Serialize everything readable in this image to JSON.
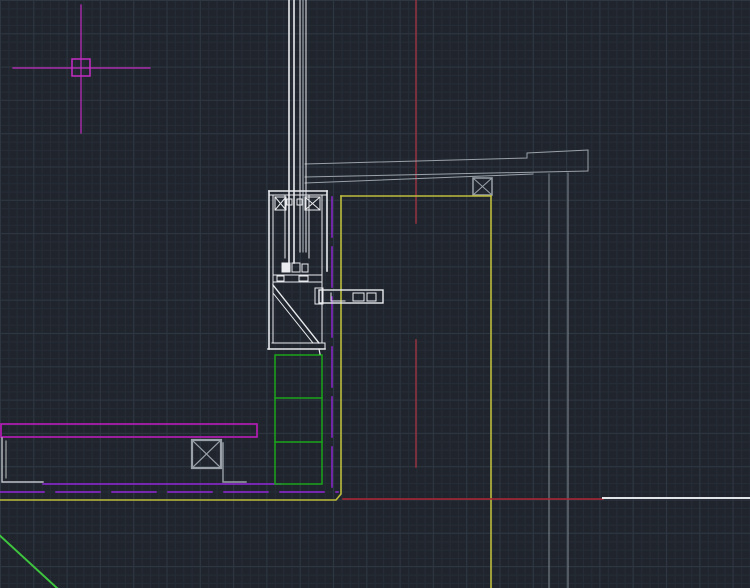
{
  "app": {
    "name": "cad-drawing-viewport",
    "description": "Dark CAD model-space viewport showing a curtain-wall mullion / parapet construction detail section",
    "visible_text": []
  },
  "canvas": {
    "width": 750,
    "height": 588,
    "background": "#20252d",
    "grid": {
      "fine_spacing_px": 8.33,
      "fine_color": "#262c36",
      "major_spacing_px": 33.3,
      "major_color": "#2e3642"
    }
  },
  "palette": {
    "magenta": "#c32cc3",
    "purple": "#9326d9",
    "yellow": "#bdbd3c",
    "green": "#1aa51a",
    "green_bright": "#3fc63f",
    "red_dark": "#963341",
    "red": "#b02533",
    "white": "#e9ebee",
    "light_gray": "#bfc4c9",
    "gray": "#9aa1a8",
    "dim_gray": "#828a92"
  },
  "drawing": {
    "elements": [
      {
        "name": "crosshair-v-line",
        "type": "line",
        "x1": 81,
        "y1": 5,
        "x2": 81,
        "y2": 133,
        "color": "#c32cc3",
        "w": 1.2
      },
      {
        "name": "crosshair-h-line",
        "type": "line",
        "x1": 13,
        "y1": 68,
        "x2": 150,
        "y2": 68,
        "color": "#c32cc3",
        "w": 1.2
      },
      {
        "name": "crosshair-pickbox",
        "type": "rect",
        "x": 72,
        "y": 59,
        "wd": 18,
        "ht": 17,
        "color": "#c32cc3",
        "w": 1.5
      },
      {
        "name": "red-centerline-upper",
        "type": "line",
        "x1": 416,
        "y1": 0,
        "x2": 416,
        "y2": 223,
        "color": "#963341",
        "w": 1.5
      },
      {
        "name": "red-centerline-lower",
        "type": "line",
        "x1": 416,
        "y1": 340,
        "x2": 416,
        "y2": 467,
        "color": "#963341",
        "w": 1.5
      },
      {
        "name": "beam-top-edge",
        "type": "polyline",
        "points": "305,164 527,158 527,153 588,150",
        "color": "#9aa1a8",
        "w": 1
      },
      {
        "name": "beam-bottom-edge",
        "type": "line",
        "x1": 305,
        "y1": 177,
        "x2": 588,
        "y2": 171,
        "color": "#9aa1a8",
        "w": 1
      },
      {
        "name": "beam-lower-chord",
        "type": "line",
        "x1": 305,
        "y1": 183,
        "x2": 533,
        "y2": 174,
        "color": "#9aa1a8",
        "w": 1
      },
      {
        "name": "beam-end-cap",
        "type": "line",
        "x1": 588,
        "y1": 150,
        "x2": 588,
        "y2": 171,
        "color": "#9aa1a8",
        "w": 1
      },
      {
        "name": "hanger-rod-left",
        "type": "line",
        "x1": 549,
        "y1": 174,
        "x2": 549,
        "y2": 588,
        "color": "#828a92",
        "w": 1
      },
      {
        "name": "hanger-rod-right",
        "type": "line",
        "x1": 568,
        "y1": 173,
        "x2": 568,
        "y2": 588,
        "color": "#828a92",
        "w": 1
      },
      {
        "name": "anchor-box-top",
        "type": "rect",
        "x": 473,
        "y": 178,
        "wd": 19,
        "ht": 17,
        "color": "#9aa1a8",
        "w": 1.5
      },
      {
        "name": "anchor-box-top-diag1",
        "type": "line",
        "x1": 473,
        "y1": 178,
        "x2": 492,
        "y2": 195,
        "color": "#9aa1a8",
        "w": 1
      },
      {
        "name": "anchor-box-top-diag2",
        "type": "line",
        "x1": 492,
        "y1": 178,
        "x2": 473,
        "y2": 195,
        "color": "#9aa1a8",
        "w": 1
      },
      {
        "name": "yellow-wall-left",
        "type": "polyline",
        "points": "0,500 336,500 341,494 341,196",
        "color": "#bdbd3c",
        "w": 1.6
      },
      {
        "name": "yellow-wall-top",
        "type": "line",
        "x1": 341,
        "y1": 196,
        "x2": 491,
        "y2": 196,
        "color": "#bdbd3c",
        "w": 1.6
      },
      {
        "name": "yellow-wall-right",
        "type": "line",
        "x1": 491,
        "y1": 196,
        "x2": 491,
        "y2": 588,
        "color": "#bdbd3c",
        "w": 1.6
      },
      {
        "name": "red-floor-line",
        "type": "line",
        "x1": 343,
        "y1": 499,
        "x2": 603,
        "y2": 499,
        "color": "#b02533",
        "w": 1.6
      },
      {
        "name": "white-floor-line",
        "type": "line",
        "x1": 603,
        "y1": 498,
        "x2": 750,
        "y2": 498,
        "color": "#e2e5e8",
        "w": 2
      },
      {
        "name": "magenta-slab-outline",
        "type": "rect",
        "x": 1,
        "y": 424,
        "wd": 256,
        "ht": 13,
        "color": "#bb1cbb",
        "w": 1.6
      },
      {
        "name": "left-angle-outer",
        "type": "polyline",
        "points": "2,438 2,482 43,482",
        "color": "#bfc4c9",
        "w": 1.4
      },
      {
        "name": "left-angle-inner",
        "type": "line",
        "x1": 6,
        "y1": 441,
        "x2": 6,
        "y2": 478,
        "color": "#bfc4c9",
        "w": 1
      },
      {
        "name": "anchor-box-left",
        "type": "rect",
        "x": 192,
        "y": 440,
        "wd": 29,
        "ht": 28,
        "color": "#9aa1a8",
        "w": 2.2
      },
      {
        "name": "anchor-box-left-diag1",
        "type": "line",
        "x1": 192,
        "y1": 440,
        "x2": 221,
        "y2": 468,
        "color": "#9aa1a8",
        "w": 1.2
      },
      {
        "name": "anchor-box-left-diag2",
        "type": "line",
        "x1": 221,
        "y1": 440,
        "x2": 192,
        "y2": 468,
        "color": "#9aa1a8",
        "w": 1.2
      },
      {
        "name": "anchor-box-left-leg",
        "type": "polyline",
        "points": "223,443 223,482 246,482",
        "color": "#9aa1a8",
        "w": 1.4
      },
      {
        "name": "purple-membrane-line",
        "type": "line",
        "x1": 43,
        "y1": 484,
        "x2": 281,
        "y2": 484,
        "color": "#9326d9",
        "w": 1.4
      },
      {
        "name": "purple-dashed-horizontal",
        "type": "line",
        "x1": 0,
        "y1": 492,
        "x2": 338,
        "y2": 492,
        "color": "#9326d9",
        "w": 1.4,
        "dash": "44 12"
      },
      {
        "name": "purple-dashed-vertical",
        "type": "line",
        "x1": 332,
        "y1": 197,
        "x2": 332,
        "y2": 490,
        "color": "#9326d9",
        "w": 1.4,
        "dash": "40 10"
      },
      {
        "name": "green-blocking-outline",
        "type": "rect",
        "x": 275,
        "y": 355,
        "wd": 47,
        "ht": 129,
        "color": "#1aa51a",
        "w": 1.5
      },
      {
        "name": "green-blocking-divider-1",
        "type": "line",
        "x1": 275,
        "y1": 398,
        "x2": 322,
        "y2": 398,
        "color": "#1aa51a",
        "w": 1.5
      },
      {
        "name": "green-blocking-divider-2",
        "type": "line",
        "x1": 275,
        "y1": 442,
        "x2": 322,
        "y2": 442,
        "color": "#1aa51a",
        "w": 1.5
      },
      {
        "name": "green-slope-line",
        "type": "line",
        "x1": -4,
        "y1": 532,
        "x2": 57,
        "y2": 588,
        "color": "#3fc63f",
        "w": 2
      },
      {
        "name": "glass-pane-outer-1",
        "type": "line",
        "x1": 289,
        "y1": 0,
        "x2": 289,
        "y2": 263,
        "color": "#e9ebee",
        "w": 1.6
      },
      {
        "name": "glass-pane-outer-2",
        "type": "line",
        "x1": 294,
        "y1": 0,
        "x2": 294,
        "y2": 263,
        "color": "#e9ebee",
        "w": 1.6
      },
      {
        "name": "glass-pane-inner-1",
        "type": "line",
        "x1": 300,
        "y1": 0,
        "x2": 300,
        "y2": 252,
        "color": "#e9ebee",
        "w": 1
      },
      {
        "name": "glass-pane-inner-2",
        "type": "line",
        "x1": 303,
        "y1": 0,
        "x2": 303,
        "y2": 252,
        "color": "#b9bfc5",
        "w": 1
      },
      {
        "name": "glass-pane-inner-3",
        "type": "line",
        "x1": 306,
        "y1": 0,
        "x2": 306,
        "y2": 252,
        "color": "#e9ebee",
        "w": 1
      },
      {
        "name": "mullion-left-wall",
        "type": "line",
        "x1": 269,
        "y1": 191,
        "x2": 269,
        "y2": 349,
        "color": "#e9ebee",
        "w": 1.6
      },
      {
        "name": "mullion-left-wall-inner",
        "type": "line",
        "x1": 273,
        "y1": 195,
        "x2": 273,
        "y2": 343,
        "color": "#e9ebee",
        "w": 1
      },
      {
        "name": "mullion-head-top",
        "type": "line",
        "x1": 269,
        "y1": 191,
        "x2": 327,
        "y2": 191,
        "color": "#e9ebee",
        "w": 1.6
      },
      {
        "name": "mullion-head-top-inner",
        "type": "line",
        "x1": 269,
        "y1": 195,
        "x2": 327,
        "y2": 195,
        "color": "#e9ebee",
        "w": 1
      },
      {
        "name": "mullion-right-wall-upper",
        "type": "line",
        "x1": 327,
        "y1": 191,
        "x2": 327,
        "y2": 271,
        "color": "#e9ebee",
        "w": 1.6
      },
      {
        "name": "mullion-right-wall-inner",
        "type": "line",
        "x1": 322,
        "y1": 195,
        "x2": 322,
        "y2": 343,
        "color": "#e9ebee",
        "w": 1
      },
      {
        "name": "mullion-sill-bottom",
        "type": "line",
        "x1": 268,
        "y1": 349,
        "x2": 325,
        "y2": 349,
        "color": "#e9ebee",
        "w": 1.6
      },
      {
        "name": "mullion-sill-top",
        "type": "line",
        "x1": 272,
        "y1": 343,
        "x2": 325,
        "y2": 343,
        "color": "#e9ebee",
        "w": 1
      },
      {
        "name": "mullion-sill-end",
        "type": "line",
        "x1": 325,
        "y1": 343,
        "x2": 325,
        "y2": 349,
        "color": "#e9ebee",
        "w": 1
      },
      {
        "name": "thermal-chamber-left",
        "type": "rect",
        "x": 275,
        "y": 197,
        "wd": 11,
        "ht": 13,
        "color": "#e9ebee",
        "w": 1
      },
      {
        "name": "thermal-chamber-left-diag1",
        "type": "line",
        "x1": 275,
        "y1": 197,
        "x2": 286,
        "y2": 210,
        "color": "#e9ebee",
        "w": 1
      },
      {
        "name": "thermal-chamber-left-diag2",
        "type": "line",
        "x1": 286,
        "y1": 197,
        "x2": 275,
        "y2": 210,
        "color": "#e9ebee",
        "w": 1
      },
      {
        "name": "thermal-chamber-right",
        "type": "rect",
        "x": 305,
        "y": 197,
        "wd": 15,
        "ht": 13,
        "color": "#e9ebee",
        "w": 1
      },
      {
        "name": "thermal-chamber-right-diag1",
        "type": "line",
        "x1": 305,
        "y1": 197,
        "x2": 320,
        "y2": 210,
        "color": "#e9ebee",
        "w": 1
      },
      {
        "name": "thermal-chamber-right-diag2",
        "type": "line",
        "x1": 320,
        "y1": 197,
        "x2": 305,
        "y2": 210,
        "color": "#e9ebee",
        "w": 1
      },
      {
        "name": "gasket-left",
        "type": "rect",
        "x": 287,
        "y": 199,
        "wd": 5,
        "ht": 6,
        "color": "#e9ebee",
        "w": 1
      },
      {
        "name": "gasket-right",
        "type": "rect",
        "x": 297,
        "y": 199,
        "wd": 5,
        "ht": 6,
        "color": "#e9ebee",
        "w": 1
      },
      {
        "name": "glazing-pocket-left",
        "type": "line",
        "x1": 285,
        "y1": 196,
        "x2": 285,
        "y2": 258,
        "color": "#e9ebee",
        "w": 1
      },
      {
        "name": "glazing-pocket-right",
        "type": "line",
        "x1": 309,
        "y1": 196,
        "x2": 309,
        "y2": 258,
        "color": "#e9ebee",
        "w": 1
      },
      {
        "name": "setting-block-solid",
        "type": "rect",
        "x": 282,
        "y": 263,
        "wd": 8,
        "ht": 9,
        "color": "#e9ebee",
        "w": 1,
        "fill": "#e9ebee"
      },
      {
        "name": "setting-block-2",
        "type": "rect",
        "x": 292,
        "y": 263,
        "wd": 8,
        "ht": 9,
        "color": "#e9ebee",
        "w": 1
      },
      {
        "name": "setting-block-3",
        "type": "rect",
        "x": 302,
        "y": 264,
        "wd": 6,
        "ht": 8,
        "color": "#e9ebee",
        "w": 1
      },
      {
        "name": "transom-band-top",
        "type": "line",
        "x1": 273,
        "y1": 275,
        "x2": 322,
        "y2": 275,
        "color": "#e9ebee",
        "w": 1
      },
      {
        "name": "transom-band-bottom",
        "type": "line",
        "x1": 273,
        "y1": 282,
        "x2": 322,
        "y2": 282,
        "color": "#e9ebee",
        "w": 1
      },
      {
        "name": "transom-clip-1",
        "type": "rect",
        "x": 277,
        "y": 276,
        "wd": 7,
        "ht": 5,
        "color": "#e9ebee",
        "w": 1
      },
      {
        "name": "transom-clip-2",
        "type": "rect",
        "x": 299,
        "y": 276,
        "wd": 9,
        "ht": 5,
        "color": "#e9ebee",
        "w": 1
      },
      {
        "name": "diagonal-brace-outer",
        "type": "line",
        "x1": 273,
        "y1": 285,
        "x2": 319,
        "y2": 343,
        "color": "#e9ebee",
        "w": 1.4
      },
      {
        "name": "diagonal-brace-inner",
        "type": "line",
        "x1": 273,
        "y1": 293,
        "x2": 313,
        "y2": 343,
        "color": "#e9ebee",
        "w": 1
      },
      {
        "name": "brace-tip",
        "type": "line",
        "x1": 319,
        "y1": 349,
        "x2": 320,
        "y2": 354,
        "color": "#e9ebee",
        "w": 1.2
      },
      {
        "name": "bracket-arm-outline",
        "type": "rect",
        "x": 319,
        "y": 290,
        "wd": 64,
        "ht": 13,
        "color": "#e9ebee",
        "w": 1.4
      },
      {
        "name": "bracket-arm-endblock",
        "type": "rect",
        "x": 315,
        "y": 288,
        "wd": 8,
        "ht": 16,
        "color": "#e9ebee",
        "w": 1
      },
      {
        "name": "bracket-arm-lmark",
        "type": "polyline",
        "points": "331,293 331,301 345,301",
        "color": "#e9ebee",
        "w": 1
      },
      {
        "name": "bracket-arm-plate-1",
        "type": "rect",
        "x": 353,
        "y": 293,
        "wd": 11,
        "ht": 8,
        "color": "#e9ebee",
        "w": 1
      },
      {
        "name": "bracket-arm-plate-2",
        "type": "rect",
        "x": 367,
        "y": 293,
        "wd": 9,
        "ht": 8,
        "color": "#e9ebee",
        "w": 1
      }
    ]
  }
}
